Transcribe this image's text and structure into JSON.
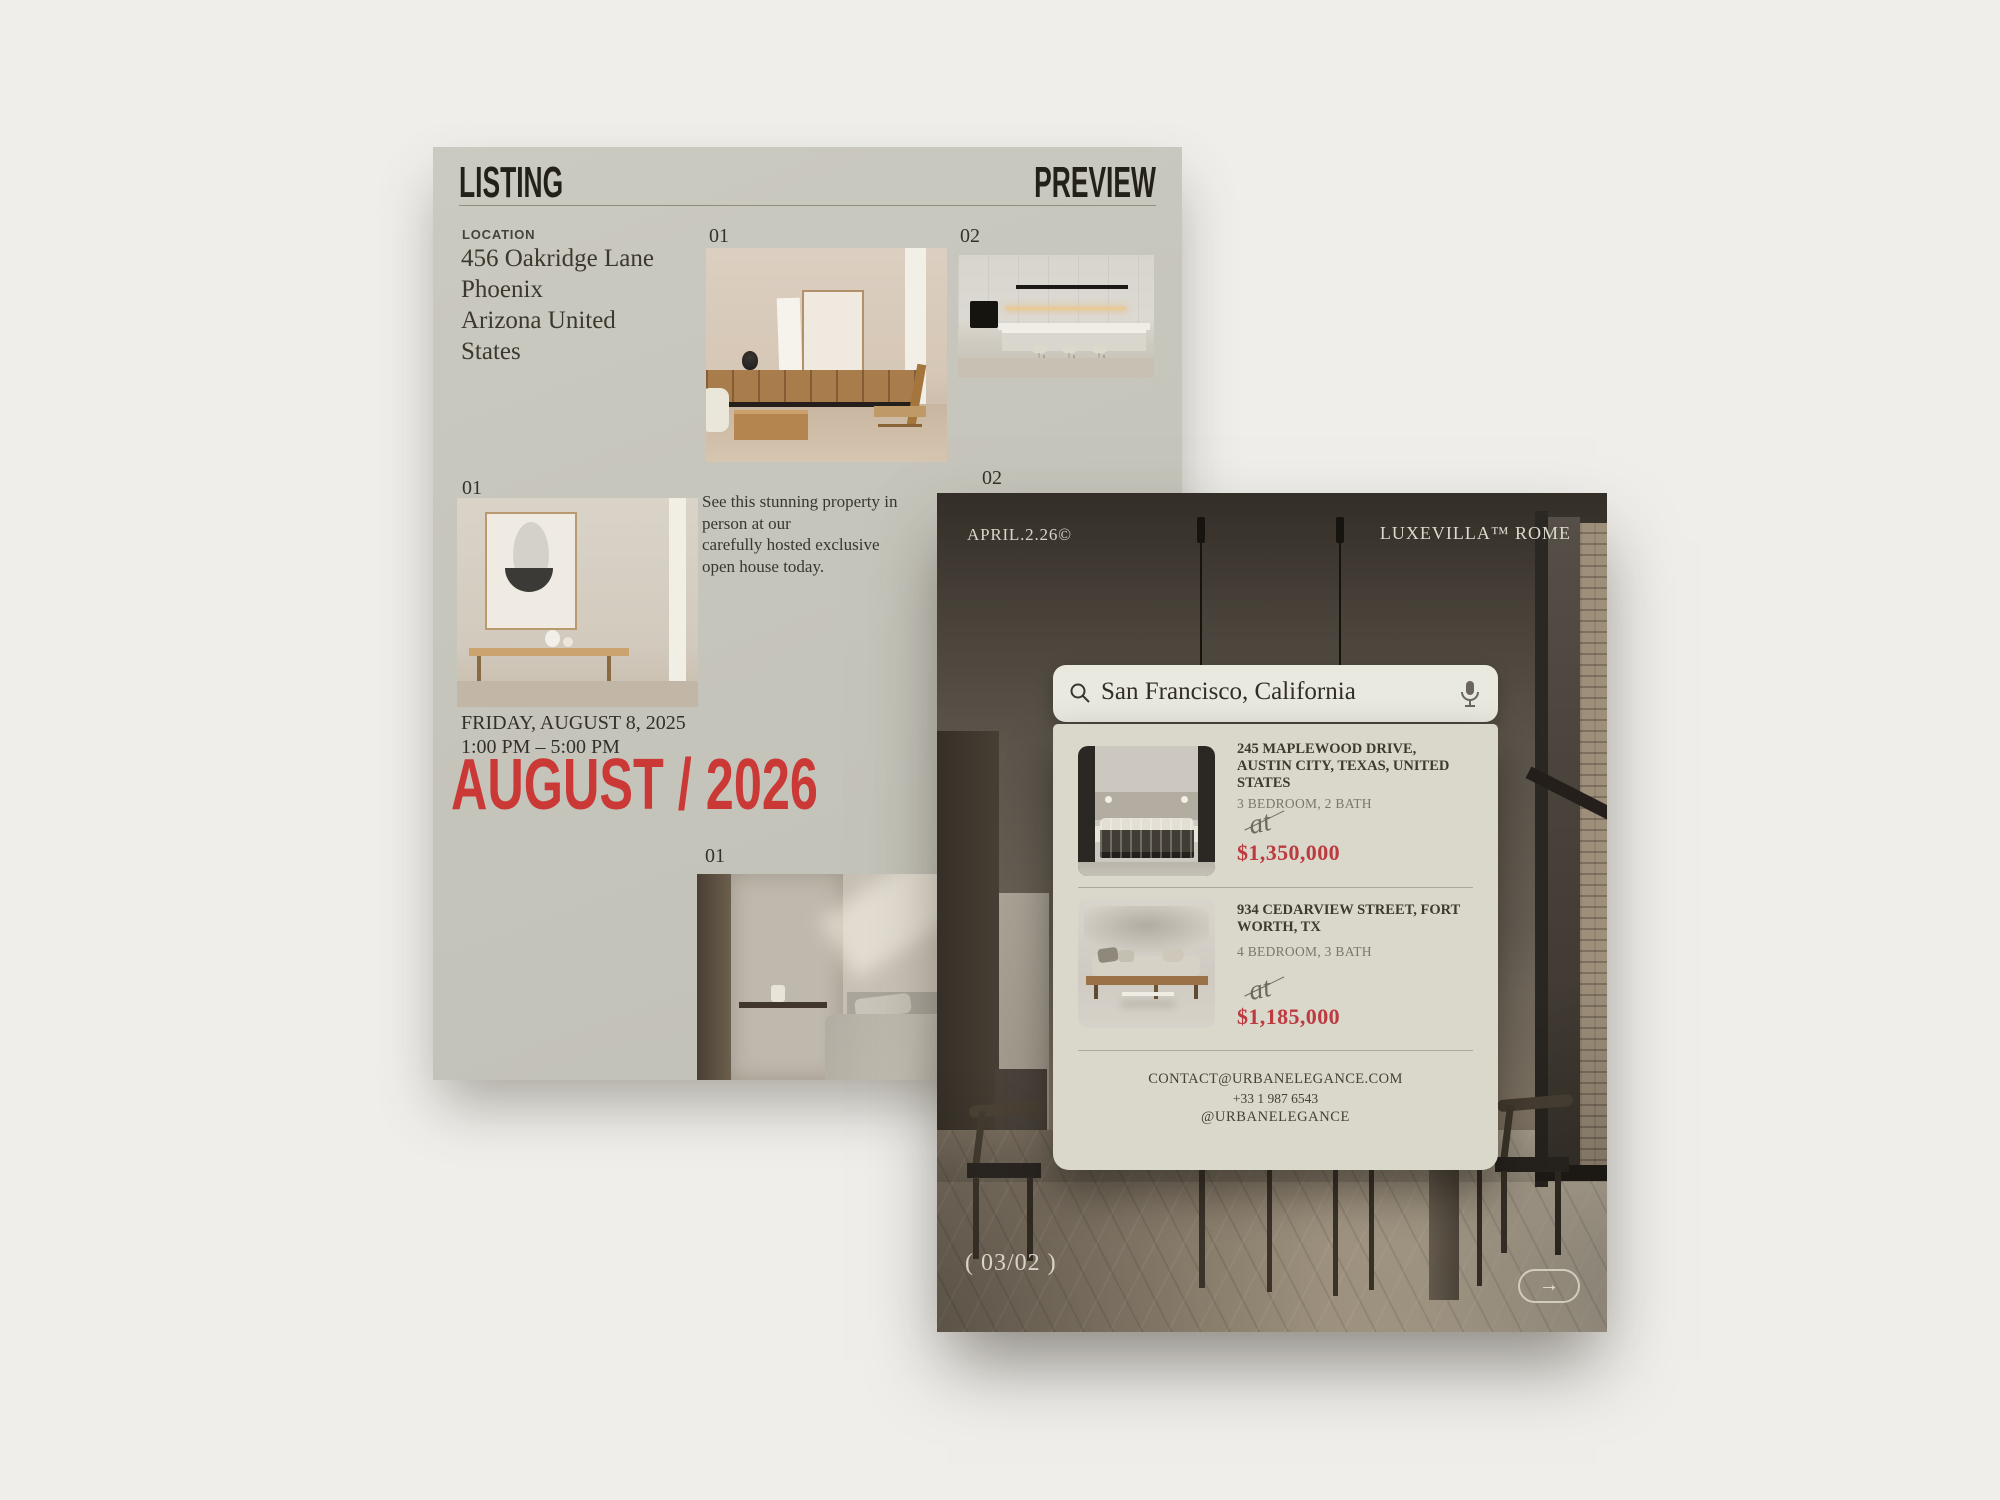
{
  "colors": {
    "page_bg": "#efeeea",
    "flyer_bg": "#c6c5bb",
    "accent_red": "#ca3936",
    "price_red": "#bc3a40",
    "panel_bg": "#d9d8ca",
    "search_bg": "#eae9df"
  },
  "flyer": {
    "header": {
      "left": "LISTING",
      "right": "PREVIEW"
    },
    "location": {
      "label": "LOCATION",
      "lines": [
        "456 Oakridge Lane",
        "Phoenix",
        "Arizona United",
        "States"
      ]
    },
    "figures": {
      "living_room_label": "01",
      "kitchen_label": "02",
      "hallway_label": "01",
      "hidden_label": "02",
      "bedroom_label": "01"
    },
    "description_lines": [
      "See this stunning property in",
      "person at our",
      "carefully hosted exclusive",
      "open house today."
    ],
    "event": {
      "date": "FRIDAY, AUGUST 8, 2025",
      "time": "1:00 PM – 5:00 PM",
      "headline": "AUGUST / 2026"
    }
  },
  "app": {
    "topbar": {
      "left": "APRIL.2.26©",
      "right": "LUXEVILLA™ ROME"
    },
    "search": {
      "value": "San Francisco, California",
      "search_icon": "magnifier",
      "mic_icon": "microphone"
    },
    "listings": [
      {
        "address_lines": [
          "245 MAPLEWOOD DRIVE,",
          "AUSTIN CITY, TEXAS, UNITED",
          "STATES"
        ],
        "specs": "3 BEDROOM, 2 BATH",
        "price_prefix": "at",
        "price": "$1,350,000"
      },
      {
        "address_lines": [
          "934 CEDARVIEW STREET, FORT",
          "WORTH, TX"
        ],
        "specs": "4 BEDROOM, 3 BATH",
        "price_prefix": "at",
        "price": "$1,185,000"
      }
    ],
    "contact": {
      "email": "CONTACT@URBANELEGANCE.COM",
      "phone": "+33 1 987 6543",
      "handle": "@URBANELEGANCE"
    },
    "pagination": "( 03/02 )",
    "next_label": "→"
  }
}
